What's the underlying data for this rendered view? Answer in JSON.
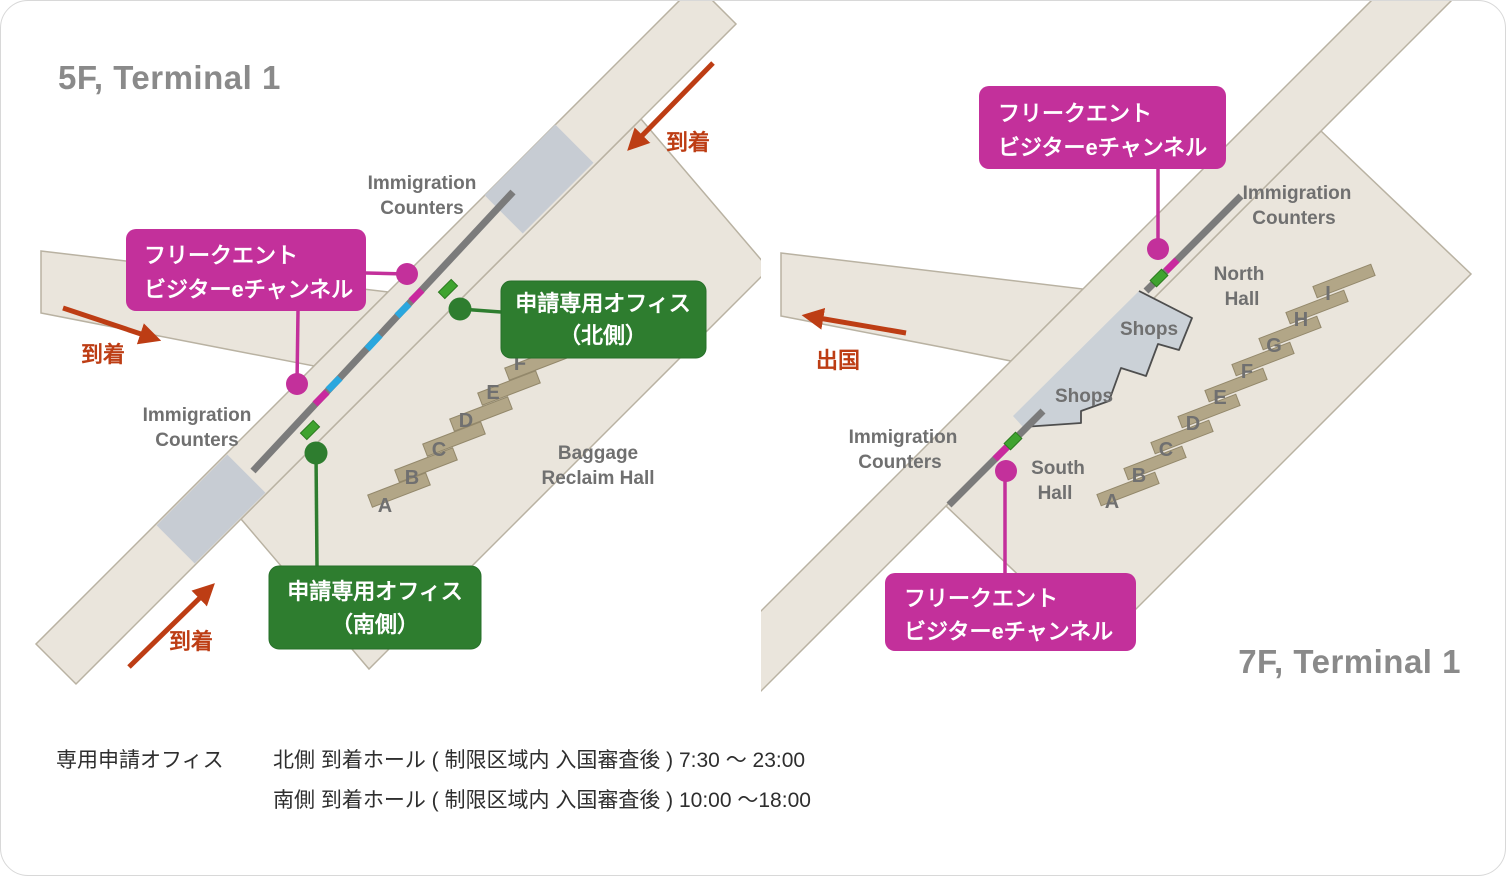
{
  "colors": {
    "accent_pink": "#C3309B",
    "accent_green": "#2E7D2F",
    "arrow_red": "#BD3D14",
    "segment_cyan": "#2AA7DE",
    "segment_pink": "#C9299E",
    "floor_beige": "#EAE5DC",
    "counter_gray": "#7B7B7B",
    "belt_tan": "#B2A687",
    "shops_gray": "#CBD1D7",
    "cap_gray": "#C7CCD3",
    "title_gray": "#8A8A8A",
    "label_gray": "#707070"
  },
  "left_map": {
    "title": "5F, Terminal 1",
    "immigration_top": {
      "line1": "Immigration",
      "line2": "Counters"
    },
    "immigration_left": {
      "line1": "Immigration",
      "line2": "Counters"
    },
    "baggage_hall": {
      "line1": "Baggage",
      "line2": "Reclaim Hall"
    },
    "belts": [
      "A",
      "B",
      "C",
      "D",
      "E",
      "F"
    ],
    "arrows": {
      "top": "到着",
      "left": "到着",
      "bottom": "到着"
    },
    "callout_evchannel": {
      "line1": "フリークエント",
      "line2": "ビジターeチャンネル"
    },
    "callout_office_north": {
      "line1": "申請専用オフィス",
      "line2": "（北側）"
    },
    "callout_office_south": {
      "line1": "申請専用オフィス",
      "line2": "（南側）"
    }
  },
  "right_map": {
    "title": "7F, Terminal 1",
    "immigration_top": {
      "line1": "Immigration",
      "line2": "Counters"
    },
    "immigration_left": {
      "line1": "Immigration",
      "line2": "Counters"
    },
    "north_hall": {
      "line1": "North",
      "line2": "Hall"
    },
    "south_hall": {
      "line1": "South",
      "line2": "Hall"
    },
    "shops_upper": "Shops",
    "shops_lower": "Shops",
    "belts": [
      "A",
      "B",
      "C",
      "D",
      "E",
      "F",
      "G",
      "H",
      "I"
    ],
    "arrow_departure": "出国",
    "callout_evchannel_top": {
      "line1": "フリークエント",
      "line2": "ビジターeチャンネル"
    },
    "callout_evchannel_bottom": {
      "line1": "フリークエント",
      "line2": "ビジターeチャンネル"
    }
  },
  "footer": {
    "heading": "専用申請オフィス",
    "line1": "北側 到着ホール ( 制限区域内 入国審査後 ) 7:30 ～ 23:00",
    "line2": "南側 到着ホール ( 制限区域内 入国審査後 ) 10:00 ～18:00"
  }
}
